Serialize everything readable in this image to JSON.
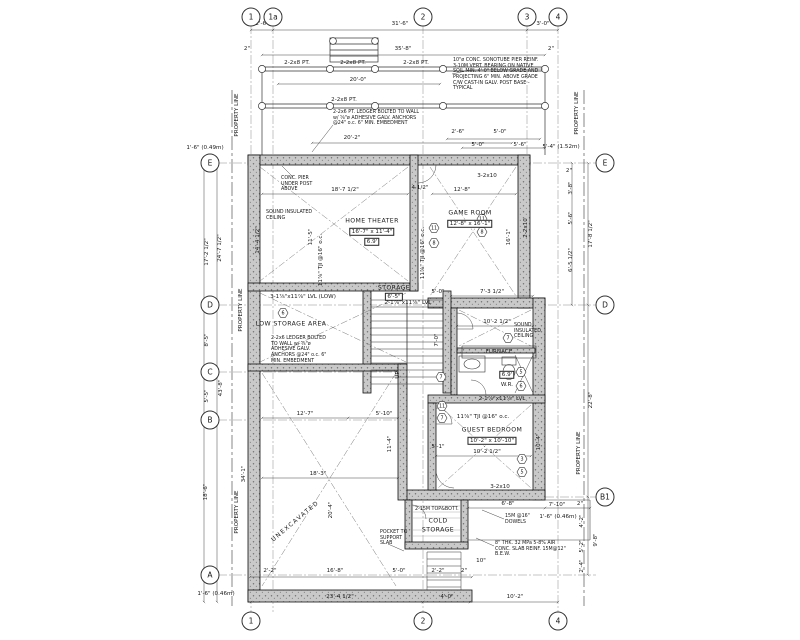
{
  "grid": {
    "top": [
      "1",
      "1a",
      "2",
      "3",
      "4"
    ],
    "bottom": [
      "1",
      "2",
      "4"
    ],
    "left": [
      "E",
      "D",
      "C",
      "B",
      "A"
    ],
    "right": [
      "E",
      "D",
      "B1"
    ]
  },
  "rooms": {
    "home_theater": {
      "name": "HOME THEATER",
      "size": "16'-7\" x 11'-4\"",
      "height": "6.9'"
    },
    "game_room": {
      "name": "GAME ROOM",
      "size": "12'-8\" x 16'-1\""
    },
    "low_storage": {
      "name": "LOW STORAGE AREA"
    },
    "storage": {
      "name": "STORAGE",
      "size": "6'-5\""
    },
    "furnace": {
      "name": "FURNACE"
    },
    "wr": {
      "name": "W.R.",
      "height": "6.9'"
    },
    "guest_bedroom": {
      "name": "GUEST BEDROOM",
      "size": "10'-2\" x 10'-10\""
    },
    "cold_1": "COLD",
    "cold_2": "STORAGE",
    "unexcavated": "UNEXCAVATED",
    "up": "UP"
  },
  "notes": {
    "pier": "10\"ø CONC. SONOTUBE PIER REINF. 3-10M VERT. BEARING ON NATIVE SOIL MIN. 4'-0\" BELOW GRADE AND PROJECTING 6\" MIN. ABOVE GRADE C/W CAST-IN GALV. POST BASE -TYPICAL",
    "ledger_pt": "2-2x6 PT. LEDGER BOLTED TO WALL w/ ⅝\"ø ADHESIVE GALV. ANCHORS @24\" o.c. 6\" MIN. EMBEDMENT",
    "ledger_low": "2-2x6 LEDGER BOLTED TO WALL w/ ⅝\"ø ADHESIVE GALV. ANCHORS @24\" o.c. 6\" MIN. EMBEDMENT",
    "conc_pier": "CONC. PIER UNDER POST ABOVE",
    "sound": "SOUND INSULATED CEILING",
    "dowels": "15M @16\" DOWELS",
    "slab": "8\" THK. 32 MPa 5-8% AIR CONC. SLAB REINF. 15M@12\" B.E.W.",
    "pocket": "POCKET TO SUPPORT SLAB",
    "property_line": "PROPERTY LINE"
  },
  "struct": {
    "pt_beam": "2-2x8 PT.",
    "lvl_low": "3-1⅞\"x11⅞\" LVL (LOW)",
    "lvl": "2-1⅞\"x11⅞\" LVL",
    "b3210": "3-2x10",
    "b2210": "2-2x10",
    "tji": "11⅞\" TJI @16\" o.c.",
    "topbott": "2-15M TOP&BOTT."
  },
  "tags": {
    "a": "11",
    "b": "8",
    "c": "6",
    "d": "7",
    "e": "5",
    "f": "3"
  },
  "dims": {
    "t1": "2'-6\"",
    "t2": "31'-6\"",
    "t3": "3'-0\"",
    "t4": "2\"",
    "t5": "35'-8\"",
    "t6": "2\"",
    "deck1": "20'-0\"",
    "deck2": "20'-2\"",
    "lo": "1'-6\" (0.49m)",
    "ro": "5'-4\" (1.52m)",
    "bo": "1'-6\" (0.46m)",
    "rco": "1'-6\" (0.46m)",
    "tr1": "2'-6\"",
    "tr2": "5'-0\"",
    "tr3": "5'-0\"",
    "tr4": "5'-6\"",
    "l1": "17'-2 1/2\"",
    "l2": "24'-7 1/2\"",
    "l3": "8'-5\"",
    "l4": "5'-5\"",
    "l5": "43'-8\"",
    "l6": "34'-1\"",
    "l7": "18'-6\"",
    "r1": "2\"",
    "r2": "3'-8\"",
    "r3": "5'-6\"",
    "r4": "6'-5 1/2\"",
    "r5": "17'-8 1/2\"",
    "r6": "22'-8\"",
    "r7": "4'-2\"",
    "r8": "5'-2\"",
    "r9": "2'-4\"",
    "r10": "9'-8\"",
    "r11": "2\"",
    "c1": "6'-8\"",
    "c2": "7'-10\"",
    "c3": "10\"",
    "b1": "2'-2\"",
    "b2": "16'-8\"",
    "b3": "5'-0\"",
    "b4": "2'-2\"",
    "b5": "2\"",
    "m1": "23'-4 1/2\"",
    "m2": "4'-0\"",
    "m3": "10'-2\"",
    "ht1": "18'-7 1/2\"",
    "ht2": "4 1/2\"",
    "ht3": "14'-4 1/2\"",
    "ht4": "11'-5\"",
    "gr1": "12'-8\"",
    "gr2": "16'-1\"",
    "st1": "5'-0\"",
    "st2": "7'-3 1/2\"",
    "st3": "7'-0\"",
    "fw1": "10'-2 1/2\"",
    "gb1": "10'-2 1/2\"",
    "gb2": "5'-1\"",
    "gb3": "10'-4\"",
    "u1": "12'-7\"",
    "u2": "5'-10\"",
    "u3": "11'-4\"",
    "u4": "18'-3\"",
    "u5": "20'-4\""
  }
}
